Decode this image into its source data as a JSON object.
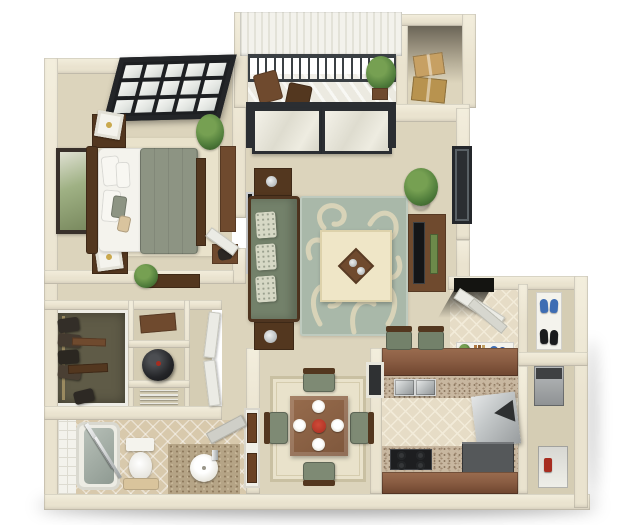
{
  "scene": {
    "type": "3d-floor-plan-render",
    "view": "top-down isometric apartment floor plan",
    "rooms": [
      "bedroom",
      "balcony",
      "storage-closet",
      "living-room",
      "entry-foyer",
      "shoe-closet",
      "walk-in-closet",
      "utility-closets",
      "hallway",
      "bathroom",
      "dining-area",
      "kitchen",
      "utility-room"
    ]
  },
  "counts": {
    "window_panes": 15,
    "balusters": 18,
    "sofa_cushions": 3,
    "dining_plates": 4,
    "burners": 4,
    "rack_slats": 4,
    "sink_basins": 2
  },
  "palette": {
    "wall": "#eae3cf",
    "wall_shade": "#cfc7ab",
    "carpet": "#dcd4bc",
    "carpet_dark": "#d5cdb4",
    "rug_cream": "#e9e2cb",
    "tile": "#e6dcc6",
    "tile_line": "#f2ebd9",
    "bath_tile": "#d8c9ac",
    "closet_floor": "#5f5b47",
    "balcony_floor": "#eceae1",
    "roof": "#f3f2ec",
    "railing": "#3b4044",
    "glass": "#e9e7db",
    "frame_dark": "#2b2e32",
    "sofa": "#73816a",
    "sofa_dark": "#5c6951",
    "cushion": "#d6d8c5",
    "area_rug": "#a9b8a9",
    "swirl": "#dbd5b9",
    "ottoman": "#efe6c7",
    "wood_dark": "#53371f",
    "wood_mid": "#6f4a2e",
    "counter_wood": "#8a5d43",
    "granite": "#c8b7a0",
    "granite_dark": "#a08a72",
    "steel": "#b9bdbe",
    "appliance_gray": "#55585a",
    "cooktop": "#1d1e20",
    "bed_blanket": "#8d9483",
    "white_soft": "#f4f3ed",
    "plant": "#4e7b3a",
    "plant_light": "#76a052",
    "shoe_blue": "#3e6db3",
    "shoe_black": "#1a1b1d",
    "accent_red": "#a72d20",
    "door_brown": "#6b4226",
    "shadow": "rgba(0,0,0,0.38)"
  }
}
